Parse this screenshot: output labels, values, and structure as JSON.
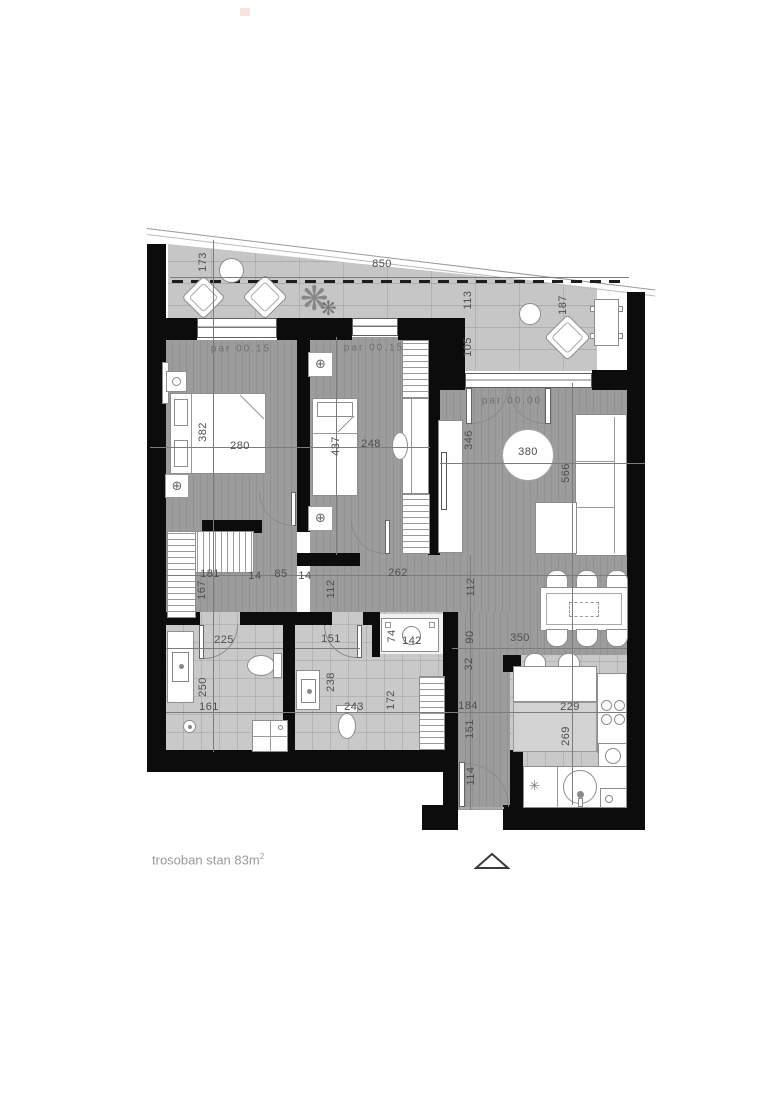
{
  "plan": {
    "footer_label": "trosoban stan 83m",
    "footer_sup": "2"
  },
  "symbols": {
    "light": "⊕",
    "star": "✳",
    "plant": "❋"
  },
  "floor_labels": [
    {
      "text": "par 00.15",
      "x": 241,
      "y": 349
    },
    {
      "text": "par 00.15",
      "x": 374,
      "y": 348
    },
    {
      "text": "par 00.00",
      "x": 512,
      "y": 401
    }
  ],
  "dimensions": [
    {
      "text": "173",
      "x": 203,
      "y": 262,
      "o": "v"
    },
    {
      "text": "850",
      "x": 382,
      "y": 264,
      "o": "h"
    },
    {
      "text": "113",
      "x": 468,
      "y": 300,
      "o": "v"
    },
    {
      "text": "105",
      "x": 468,
      "y": 347,
      "o": "v"
    },
    {
      "text": "187",
      "x": 563,
      "y": 305,
      "o": "v"
    },
    {
      "text": "382",
      "x": 203,
      "y": 432,
      "o": "v"
    },
    {
      "text": "280",
      "x": 240,
      "y": 446,
      "o": "h"
    },
    {
      "text": "437",
      "x": 336,
      "y": 446,
      "o": "v"
    },
    {
      "text": "248",
      "x": 371,
      "y": 444,
      "o": "h"
    },
    {
      "text": "346",
      "x": 469,
      "y": 440,
      "o": "v"
    },
    {
      "text": "380",
      "x": 528,
      "y": 452,
      "o": "h"
    },
    {
      "text": "566",
      "x": 566,
      "y": 473,
      "o": "v"
    },
    {
      "text": "181",
      "x": 210,
      "y": 574,
      "o": "h"
    },
    {
      "text": "14",
      "x": 255,
      "y": 576,
      "o": "h"
    },
    {
      "text": "85",
      "x": 281,
      "y": 574,
      "o": "h"
    },
    {
      "text": "14",
      "x": 305,
      "y": 576,
      "o": "h"
    },
    {
      "text": "262",
      "x": 398,
      "y": 573,
      "o": "h"
    },
    {
      "text": "167",
      "x": 202,
      "y": 590,
      "o": "v"
    },
    {
      "text": "112",
      "x": 331,
      "y": 589,
      "o": "v"
    },
    {
      "text": "112",
      "x": 471,
      "y": 587,
      "o": "v"
    },
    {
      "text": "225",
      "x": 224,
      "y": 640,
      "o": "h"
    },
    {
      "text": "250",
      "x": 203,
      "y": 687,
      "o": "v"
    },
    {
      "text": "161",
      "x": 209,
      "y": 707,
      "o": "h"
    },
    {
      "text": "151",
      "x": 331,
      "y": 639,
      "o": "h"
    },
    {
      "text": "238",
      "x": 331,
      "y": 682,
      "o": "v"
    },
    {
      "text": "243",
      "x": 354,
      "y": 707,
      "o": "h"
    },
    {
      "text": "172",
      "x": 391,
      "y": 700,
      "o": "v"
    },
    {
      "text": "74",
      "x": 392,
      "y": 636,
      "o": "v"
    },
    {
      "text": "142",
      "x": 412,
      "y": 641,
      "o": "h"
    },
    {
      "text": "90",
      "x": 470,
      "y": 637,
      "o": "v"
    },
    {
      "text": "32",
      "x": 469,
      "y": 664,
      "o": "v"
    },
    {
      "text": "184",
      "x": 468,
      "y": 706,
      "o": "h"
    },
    {
      "text": "151",
      "x": 470,
      "y": 729,
      "o": "v"
    },
    {
      "text": "114",
      "x": 471,
      "y": 776,
      "o": "v"
    },
    {
      "text": "350",
      "x": 520,
      "y": 638,
      "o": "h"
    },
    {
      "text": "229",
      "x": 570,
      "y": 707,
      "o": "h"
    },
    {
      "text": "269",
      "x": 566,
      "y": 736,
      "o": "v"
    }
  ]
}
